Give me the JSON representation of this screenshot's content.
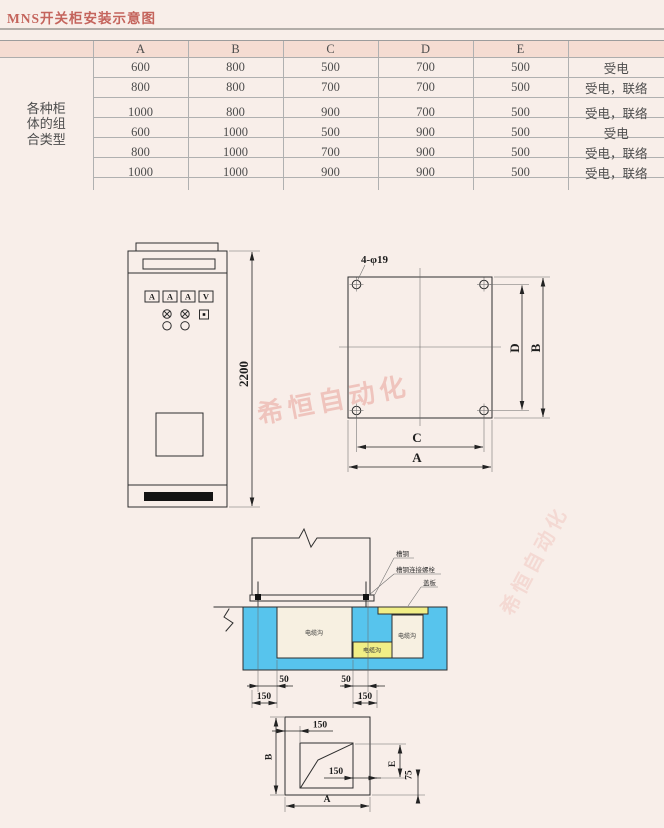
{
  "page": {
    "title": "MNS开关柜安装示意图"
  },
  "table": {
    "columns": [
      "A",
      "B",
      "C",
      "D",
      "E"
    ],
    "group_label": "各种柜\n体的组\n合类型",
    "rows": [
      {
        "A": "600",
        "B": "800",
        "C": "500",
        "D": "700",
        "E": "500",
        "type": "受电"
      },
      {
        "A": "800",
        "B": "800",
        "C": "700",
        "D": "700",
        "E": "500",
        "type": "受电，联络"
      },
      {
        "A": "1000",
        "B": "800",
        "C": "900",
        "D": "700",
        "E": "500",
        "type": "受电，联络"
      },
      {
        "A": "600",
        "B": "1000",
        "C": "500",
        "D": "900",
        "E": "500",
        "type": "受电"
      },
      {
        "A": "800",
        "B": "1000",
        "C": "700",
        "D": "900",
        "E": "500",
        "type": "受电，联络"
      },
      {
        "A": "1000",
        "B": "1000",
        "C": "900",
        "D": "900",
        "E": "500",
        "type": "受电，联络"
      }
    ]
  },
  "front_view": {
    "meters": [
      "A",
      "A",
      "A",
      "V"
    ],
    "height_dim": "2200"
  },
  "top_view": {
    "holes_label": "4-φ19",
    "dim_c": "C",
    "dim_a": "A",
    "dim_d": "D",
    "dim_b": "B"
  },
  "section_view": {
    "label_channel_steel": "槽钢",
    "label_connecting_bolt": "槽钢连接螺栓",
    "label_cover_plate": "盖板",
    "trench_labels": [
      "电缆沟",
      "电缆沟",
      "电缆沟"
    ],
    "dims": {
      "left_50": "50",
      "right_50": "50",
      "left_150": "150",
      "right_150": "150"
    }
  },
  "bottom_view": {
    "dim_b": "B",
    "dim_a": "A",
    "dim_150_top": "150",
    "dim_150_mid": "150",
    "dim_e": "E",
    "dim_75": "75"
  },
  "watermark": {
    "text": "希恒自动化"
  },
  "colors": {
    "foundation_blue": "#57c4ed",
    "cover_yellow": "#f1ee86",
    "header_pink": "#f5dcd2",
    "title_red": "#c4645c"
  }
}
